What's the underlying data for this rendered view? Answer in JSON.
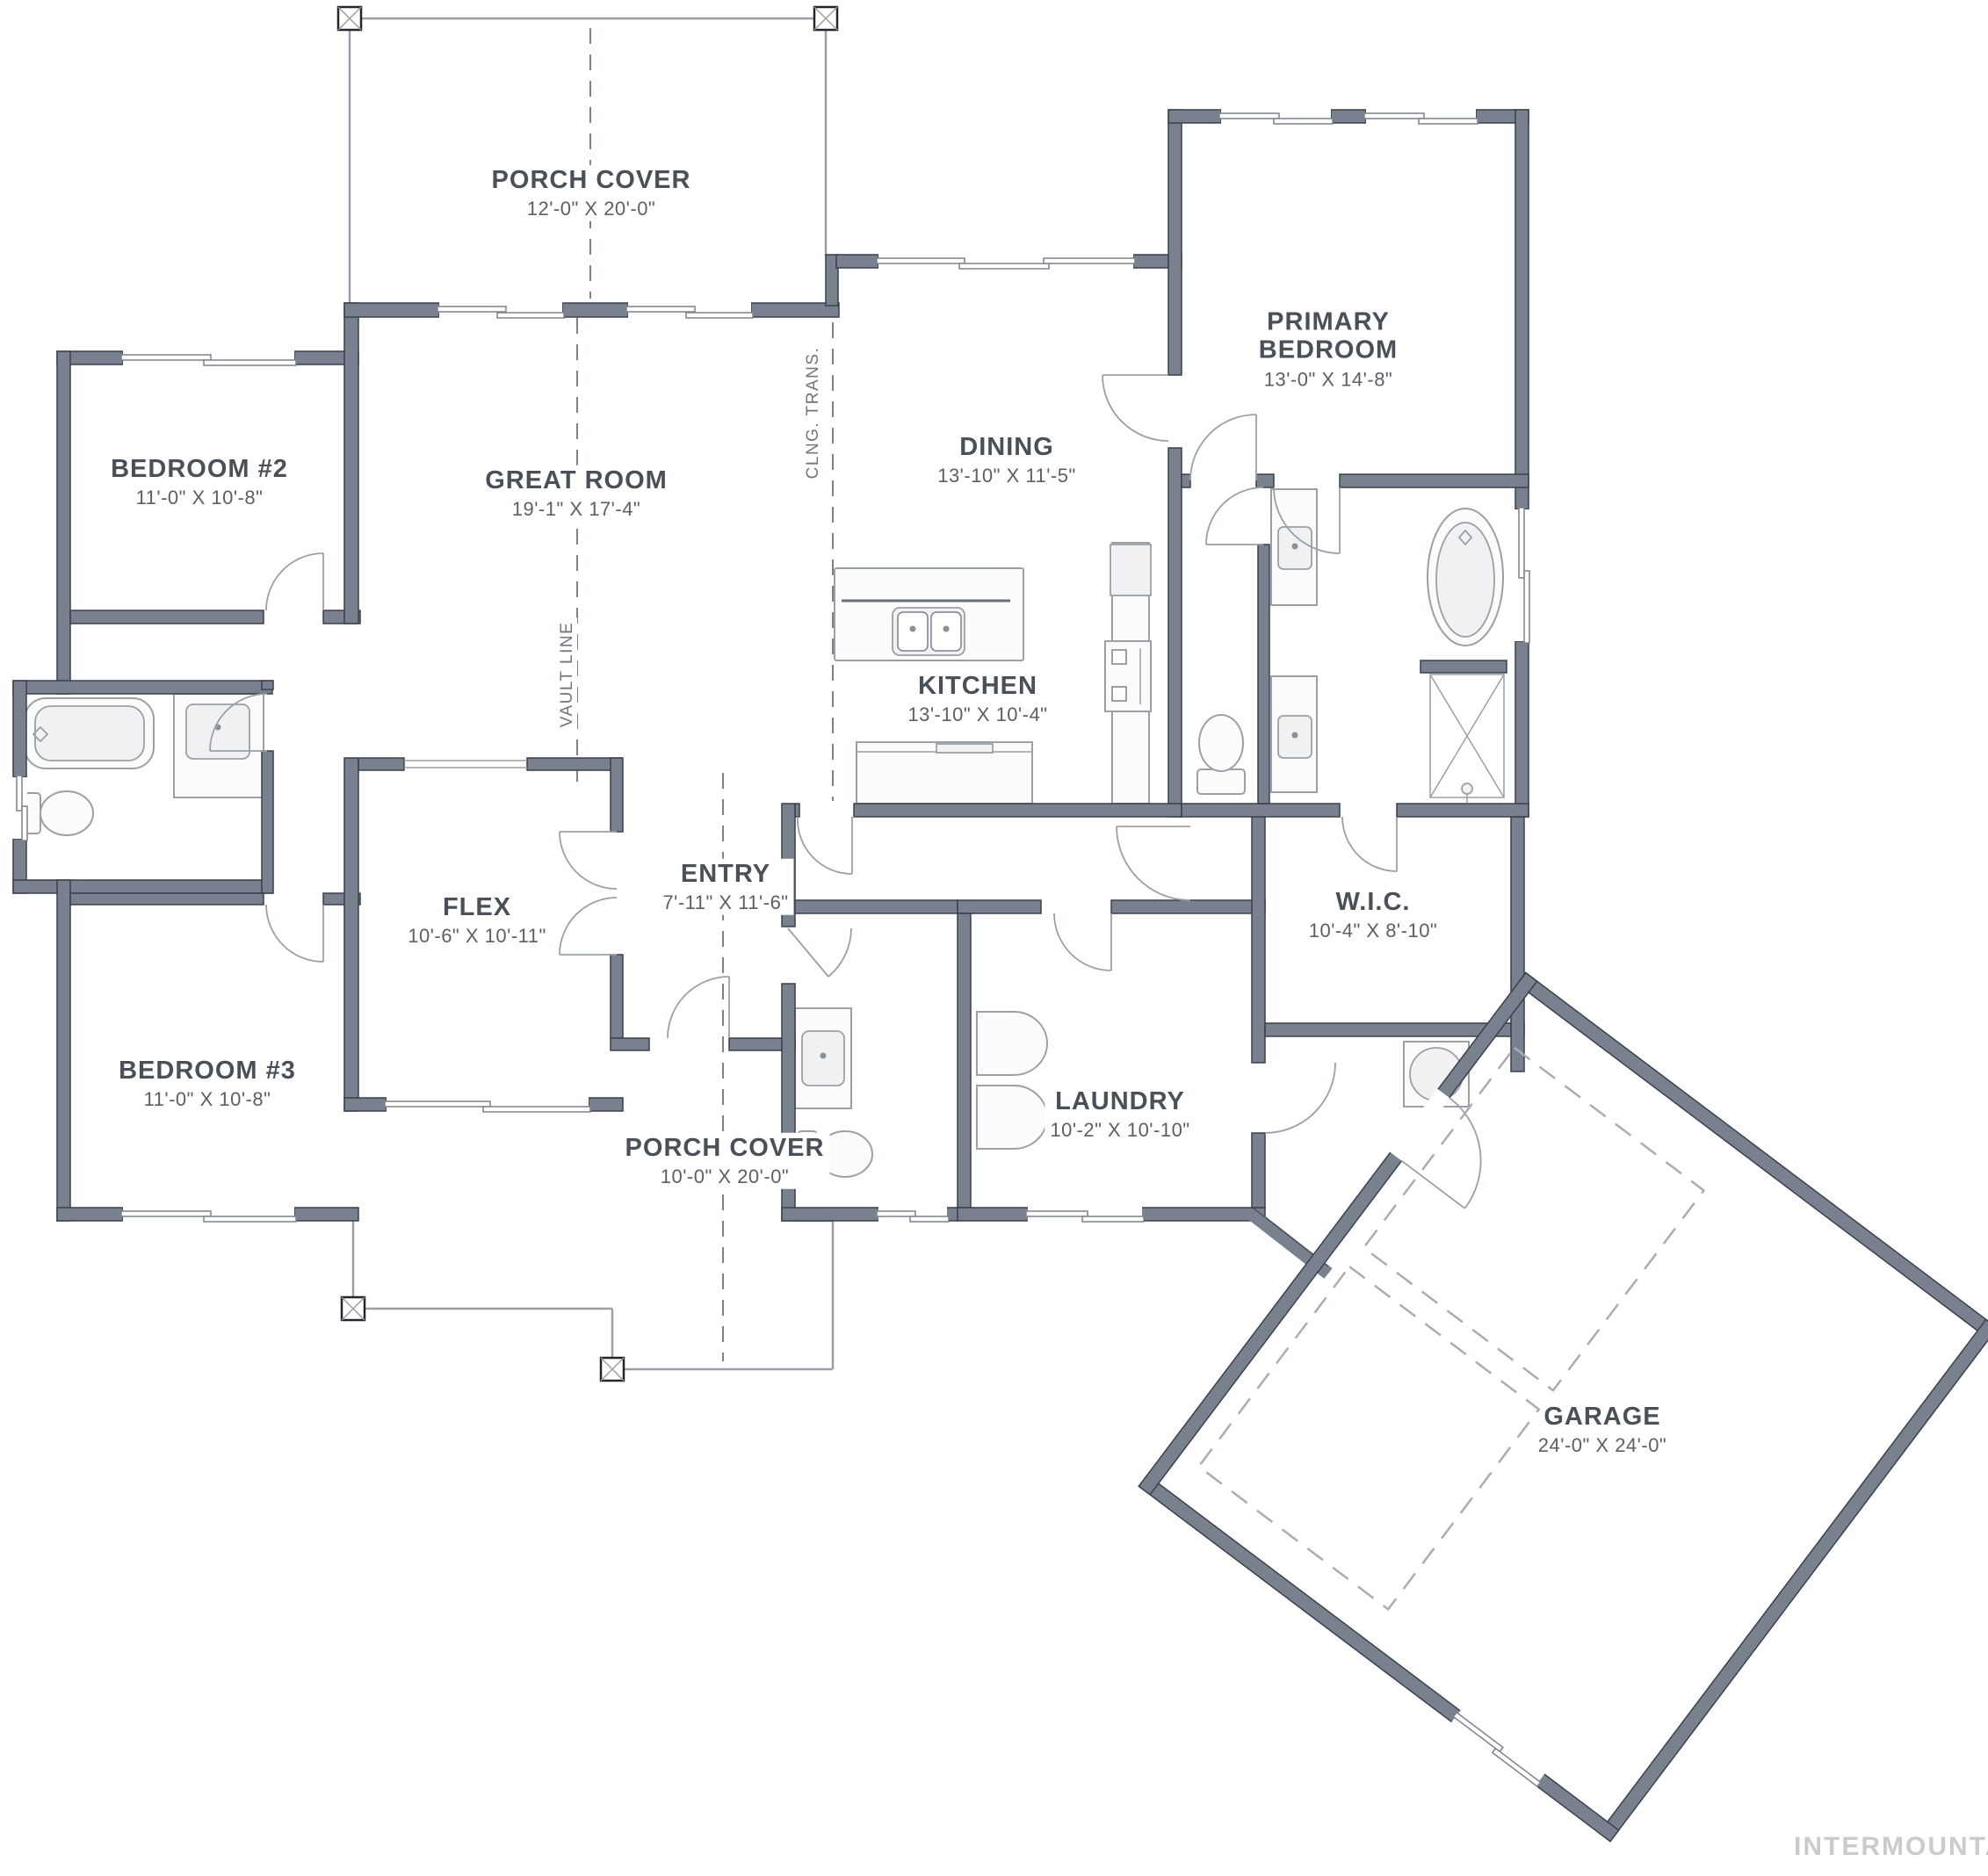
{
  "rooms": {
    "porch_top": {
      "name": "PORCH COVER",
      "dims": "12'-0\" X 20'-0\""
    },
    "great_room": {
      "name": "GREAT ROOM",
      "dims": "19'-1\" X 17'-4\""
    },
    "dining": {
      "name": "DINING",
      "dims": "13'-10\" X 11'-5\""
    },
    "primary_bedroom": {
      "name": "PRIMARY BEDROOM",
      "dims": "13'-0\" X 14'-8\""
    },
    "bedroom_2": {
      "name": "BEDROOM #2",
      "dims": "11'-0\" X 10'-8\""
    },
    "bedroom_3": {
      "name": "BEDROOM #3",
      "dims": "11'-0\" X 10'-8\""
    },
    "kitchen": {
      "name": "KITCHEN",
      "dims": "13'-10\" X 10'-4\""
    },
    "entry": {
      "name": "ENTRY",
      "dims": "7'-11\" X 11'-6\""
    },
    "flex": {
      "name": "FLEX",
      "dims": "10'-6\" X 10'-11\""
    },
    "wic": {
      "name": "W.I.C.",
      "dims": "10'-4\" X 8'-10\""
    },
    "laundry": {
      "name": "LAUNDRY",
      "dims": "10'-2\" X 10'-10\""
    },
    "porch_bottom": {
      "name": "PORCH COVER",
      "dims": "10'-0\" X 20'-0\""
    },
    "garage": {
      "name": "GARAGE",
      "dims": "24'-0\" X 24'-0\""
    }
  },
  "annotations": {
    "clng_trans": "CLNG. TRANS.",
    "vault_line": "VAULT LINE"
  },
  "watermark": "INTERMOUNTAIN",
  "colors": {
    "wall": "#78818d",
    "wall_outline": "#3b414b",
    "line": "#9aa0a6",
    "text": "#4a5058",
    "dash": "#7d828a",
    "watermark": "#c9cccf"
  }
}
